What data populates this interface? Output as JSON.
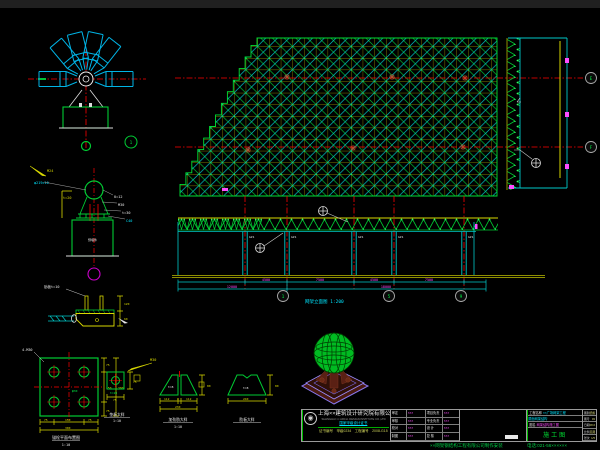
{
  "colors": {
    "grid_yellow": "#b0b000",
    "member_green": "#00cc33",
    "member_cyan": "#00c8c8",
    "tube_blue": "#00b4e6",
    "centerline_red": "#ff0000",
    "dim_magenta": "#ff4dff",
    "ground_olive": "#8f8f00",
    "accent_green": "#00dd33",
    "accent_cyan": "#00e5ff"
  },
  "bubbles": {
    "right_top": "E",
    "right_bottom": "F",
    "bottom_1": "1",
    "bottom_2": "5",
    "bottom_3": "9",
    "node_detail": "1"
  },
  "elevation": {
    "caption": "网架立面图 1:200",
    "col_label": "GZ1",
    "dims_row1": [
      "4500",
      "7500",
      "4500",
      "7500"
    ],
    "dims_row2": [
      "12000",
      "18000"
    ]
  },
  "support_detail": {
    "label_tube": "φ219×10",
    "label_anchor": "M24",
    "label_concrete": "C40",
    "ann": [
      "t=20",
      "δ=12",
      "M30",
      "t=30",
      "预埋件"
    ]
  },
  "base_detail": {
    "label": "肋板t=10",
    "dim_right_1": "120",
    "dim_right_2": "60"
  },
  "anchor_detail": {
    "leader": "4-M30",
    "center_note": "φ30",
    "dim_r": [
      "75",
      "150",
      "75"
    ],
    "dim_b": [
      "75",
      "150",
      "75"
    ],
    "total": "300",
    "caption": "锚栓平面布置图",
    "scale": "1:10"
  },
  "plate_detail": {
    "leader": "M30",
    "note": "t=20",
    "dim_r": "75",
    "dim_b": "75",
    "caption": "垫板大样",
    "scale": "1:10"
  },
  "rib_pair_detail": {
    "t": "t=8",
    "dims": [
      "112",
      "4",
      "112"
    ],
    "total": "230",
    "h": "80",
    "caption": "加劲肋大样",
    "scale": "1:10"
  },
  "rib_single_detail": {
    "t": "t=8",
    "total": "240",
    "h": "80",
    "caption": "肋板大样"
  },
  "titleblock": {
    "logo_glyph": "◉",
    "company_cn": "上海××建筑设计研究院有限公司",
    "company_en": "SHANGHAI ×× ARCH. DESIGN INSTITUTE CO.,LTD",
    "cert": "国家甲级设计证书",
    "cert_no_label": "证书编号",
    "cert_no": "甲级0234",
    "proj_no_label": "工程编号",
    "proj_no": "2008-G15",
    "sign_rows": [
      {
        "l": "审定",
        "v": "×××",
        "l2": "项目负责",
        "v2": "×××"
      },
      {
        "l": "审核",
        "v": "×××",
        "l2": "专业负责",
        "v2": "×××"
      },
      {
        "l": "校对",
        "v": "×××",
        "l2": "设 计",
        "v2": "×××"
      },
      {
        "l": "制图",
        "v": "×××",
        "l2": "复 核",
        "v2": "×××"
      }
    ],
    "project_label": "工程名称",
    "project_value": "××广场网架工程",
    "project_value2": "屋面网架结构",
    "drawing_label": "图名",
    "drawing_value": "网架结构施工图",
    "drawing_scale": "1:100",
    "stage": "施工图",
    "side_rows": [
      {
        "l": "图别",
        "v": "结施"
      },
      {
        "l": "图号",
        "v": "03"
      },
      {
        "l": "日期",
        "v": "08.6"
      },
      {
        "l": "比例",
        "v": "见图"
      },
      {
        "l": "张次",
        "v": "1/5"
      }
    ],
    "footer_left": "××网架钢结构工程有限公司制作安装",
    "footer_right": "电话:021-56××××××"
  }
}
